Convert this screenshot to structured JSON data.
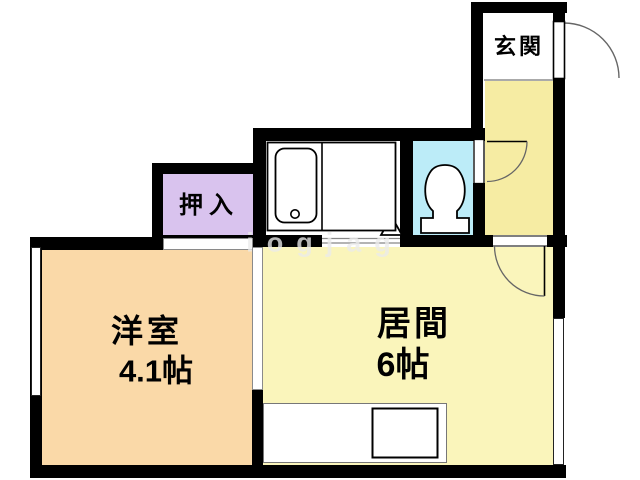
{
  "plan_title": "apartment-floorplan",
  "watermark_text": "iogjag",
  "rooms": {
    "genkan": {
      "label": "玄関"
    },
    "closet": {
      "label": "押入"
    },
    "western": {
      "label": "洋室",
      "size": "4.1帖"
    },
    "living": {
      "label": "居間",
      "size": "6帖"
    },
    "bathroom": {
      "label": ""
    },
    "toilet": {
      "label": ""
    }
  },
  "colors": {
    "wall": "#000000",
    "western_room_fill": "#FAD9A8",
    "living_room_fill": "#FAF5BB",
    "hallway_fill": "#F6ECA3",
    "closet_fill": "#D9C3EE",
    "toilet_fill": "#BCECF8",
    "bathroom_fill": "#FFFFFF",
    "door_arc": "#666666"
  },
  "fixtures": {
    "bathtub": "unit-bath-with-tub-and-drain",
    "toilet": "toilet-bowl-with-tank",
    "kitchen_sink": "kitchen-counter-with-sink",
    "entrance_door": "outward-swing-door",
    "toilet_door": "swing-door",
    "living_door": "swing-door",
    "bath_door": "folding-door-triangle"
  }
}
